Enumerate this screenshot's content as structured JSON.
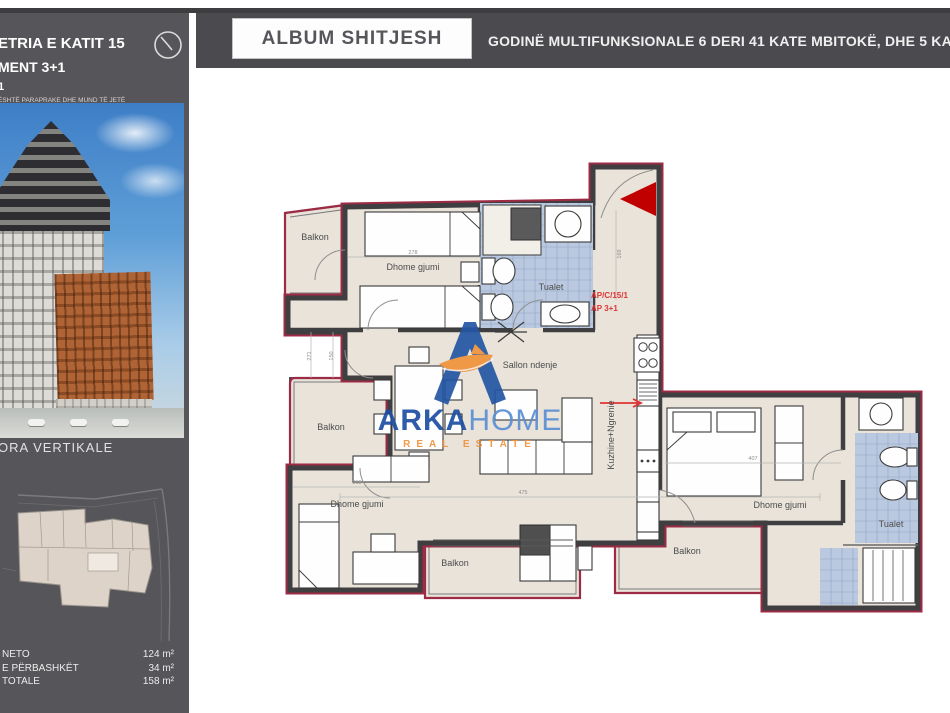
{
  "header": {
    "album_title": "ALBUM SHITJESH",
    "building_title": "GODINË MULTIFUNKSIONALE 6 DERI 41 KATE MBITOKË, DHE 5 KATE N"
  },
  "sidebar": {
    "plan_title_line1": "ETRIA E KATIT 15",
    "plan_title_line2": "MENT 3+1",
    "plan_title_line3": "1",
    "disclaimer_line1": "ËSHTË PARAPRAKE DHE MUND TË JETË",
    "disclaimer_line2": "HIMEVE TË VOGLA PËR ARSYE TEKNIKE.",
    "vertical_section_label": "ORA VERTIKALE",
    "areas": [
      {
        "label": "NETO",
        "value": "124 m²"
      },
      {
        "label": "E PËRBASHKËT",
        "value": "34 m²"
      },
      {
        "label": "TOTALE",
        "value": "158 m²"
      }
    ]
  },
  "watermark": {
    "brand_primary": "ARKA",
    "brand_secondary": "HOME",
    "tagline": "REAL ESTATE"
  },
  "plan": {
    "unit_code_line1": "AP/C/15/1",
    "unit_code_line2": "AP 3+1",
    "room_labels": [
      {
        "text": "Balkon",
        "x": 32,
        "y": 90
      },
      {
        "text": "Dhome gjumi",
        "x": 130,
        "y": 120
      },
      {
        "text": "Tualet",
        "x": 268,
        "y": 140
      },
      {
        "text": "Sallon ndenje",
        "x": 247,
        "y": 218
      },
      {
        "text": "Kuzhine+Ngrenie",
        "x": 331,
        "y": 285,
        "rot": -90
      },
      {
        "text": "Balkon",
        "x": 48,
        "y": 280
      },
      {
        "text": "Dhome gjumi",
        "x": 74,
        "y": 357
      },
      {
        "text": "Balkon",
        "x": 172,
        "y": 416
      },
      {
        "text": "Balkon",
        "x": 404,
        "y": 404
      },
      {
        "text": "Dhome gjumi",
        "x": 497,
        "y": 358
      },
      {
        "text": "Tualet",
        "x": 608,
        "y": 377
      }
    ],
    "dimensions": [
      {
        "text": "278",
        "x": 130,
        "y": 104
      },
      {
        "text": "318",
        "x": 74,
        "y": 334
      },
      {
        "text": "475",
        "x": 240,
        "y": 344
      },
      {
        "text": "407",
        "x": 470,
        "y": 310
      },
      {
        "text": "169",
        "x": 338,
        "y": 104,
        "rot": -90
      },
      {
        "text": "271",
        "x": 28,
        "y": 206,
        "rot": -90
      },
      {
        "text": "150",
        "x": 50,
        "y": 206,
        "rot": -90
      }
    ]
  },
  "colors": {
    "sidebar_bg": "#56565a",
    "header_bar_bg": "#4b4b4f",
    "floor_beige": "#e9e3da",
    "wall_dark": "#3f3e40",
    "outline_red": "#9e2b45",
    "bath_tile_blue": "#bac9e0",
    "tile_line_blue": "#8fa6c4",
    "entrance_arrow_red": "#c00000",
    "unit_code_red": "#e03434",
    "brand_blue": "#1d4fa3",
    "brand_light_blue": "#5b8fd4",
    "brand_orange": "#f0923a"
  }
}
